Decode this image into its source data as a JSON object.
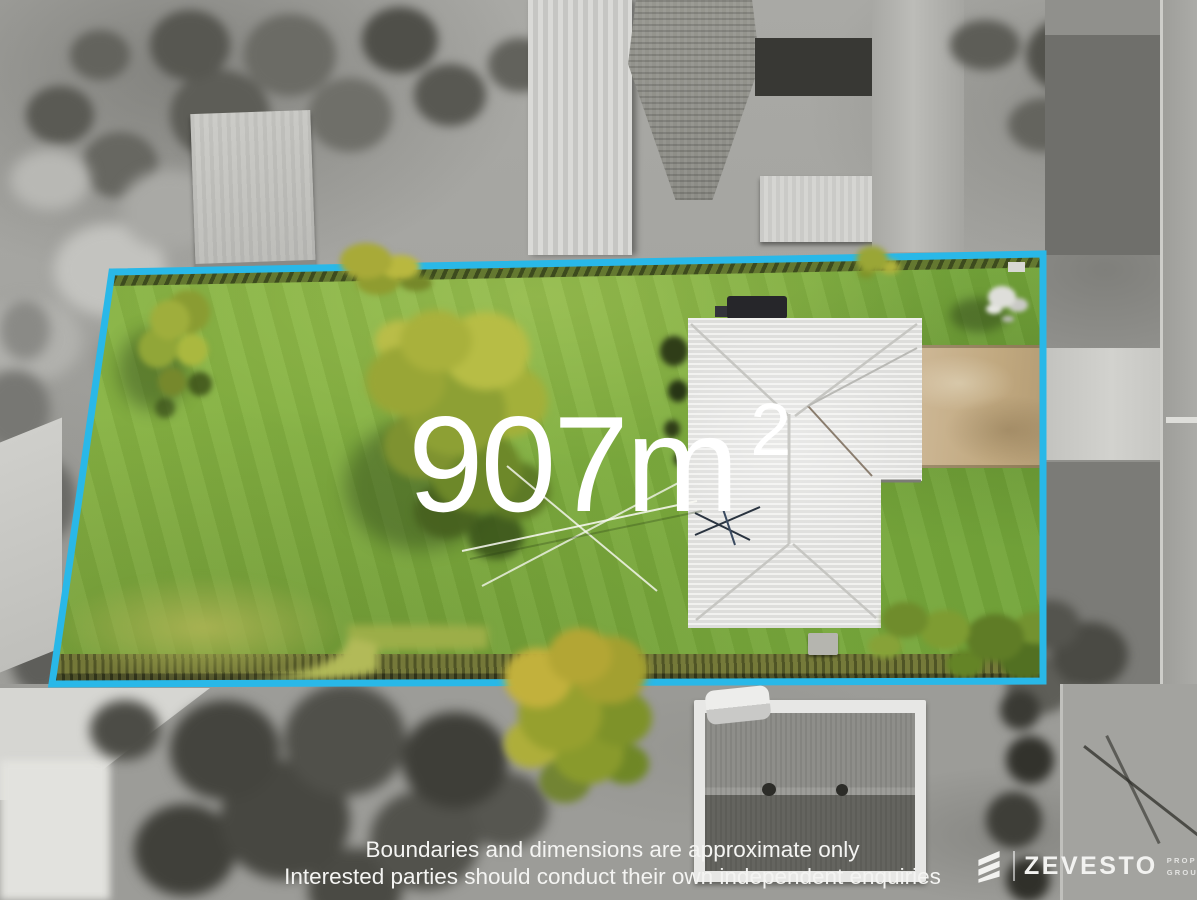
{
  "overlay": {
    "area_value": "907m",
    "area_superscript": "2",
    "disclaimer_line1": "Boundaries and dimensions are approximate only",
    "disclaimer_line2": "Interested parties should conduct their own independent enquiries"
  },
  "branding": {
    "agency_name": "ZEVESTO",
    "tagline_line1": "PROPERTY",
    "tagline_line2": "GROUP"
  },
  "boundary": {
    "color": "#29b8e8",
    "polygon_points": "112,272 1043,254 1043,681 52,684"
  },
  "palette": {
    "lawn_green": "#7fae3e",
    "house_roof_white": "#ececea",
    "driveway_tan": "#c6b08f",
    "fence_orange": "#a06a14",
    "surroundings": "desaturated-grayscale"
  }
}
